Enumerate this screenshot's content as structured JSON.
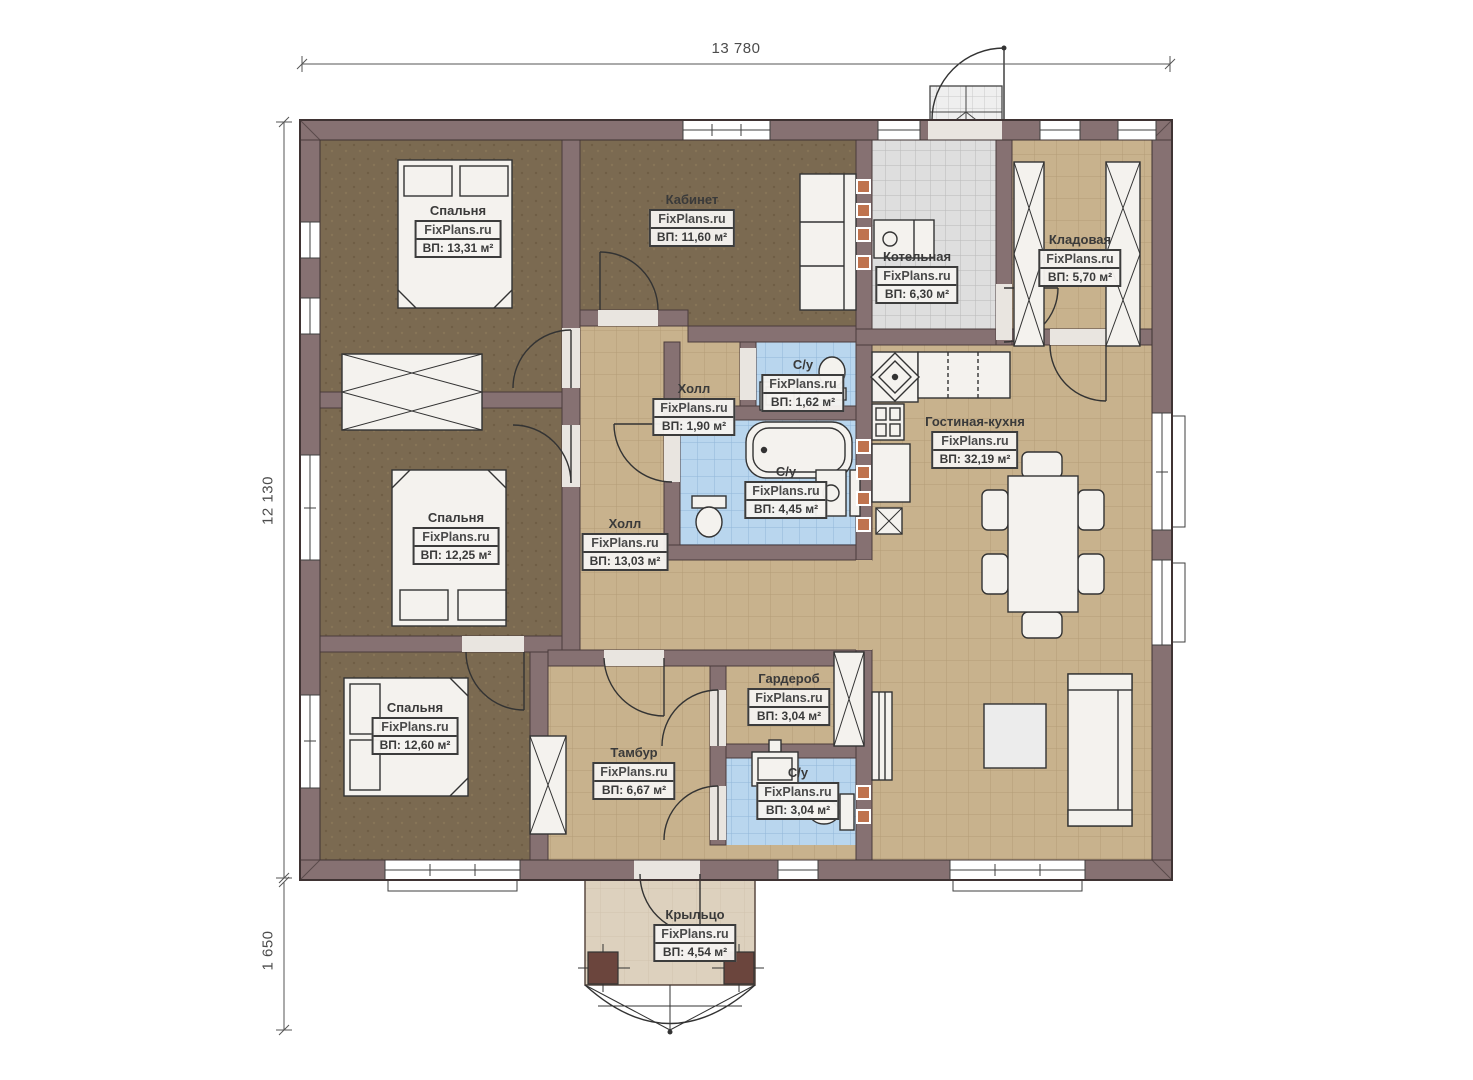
{
  "watermark": "FixPlans.ru",
  "dimensions": {
    "width_top": "13 780",
    "height_left": "12 130",
    "porch_height": "1 650"
  },
  "rooms": [
    {
      "name": "Спальня",
      "area": "ВП: 13,31 м²"
    },
    {
      "name": "Кабинет",
      "area": "ВП: 11,60 м²"
    },
    {
      "name": "Котельная",
      "area": "ВП: 6,30 м²"
    },
    {
      "name": "Кладовая",
      "area": "ВП: 5,70 м²"
    },
    {
      "name": "Холл",
      "area": "ВП: 1,90 м²"
    },
    {
      "name": "С/у",
      "area": "ВП: 1,62 м²"
    },
    {
      "name": "С/у",
      "area": "ВП: 4,45 м²"
    },
    {
      "name": "Холл",
      "area": "ВП: 13,03 м²"
    },
    {
      "name": "Гостиная-кухня",
      "area": "ВП: 32,19 м²"
    },
    {
      "name": "Спальня",
      "area": "ВП: 12,25 м²"
    },
    {
      "name": "Спальня",
      "area": "ВП: 12,60 м²"
    },
    {
      "name": "Гардероб",
      "area": "ВП: 3,04 м²"
    },
    {
      "name": "Тамбур",
      "area": "ВП: 6,67 м²"
    },
    {
      "name": "С/у",
      "area": "ВП: 3,04 м²"
    },
    {
      "name": "Крыльцо",
      "area": "ВП: 4,54 м²"
    }
  ],
  "colors": {
    "wall": "#867172",
    "floor_tan": "#c8b28d",
    "floor_brown": "#7b6a51",
    "tile_blue": "#b9d6ee",
    "tile_gray": "#dedede",
    "porch": "#ddd1be",
    "accent_orange": "#bf734e"
  }
}
